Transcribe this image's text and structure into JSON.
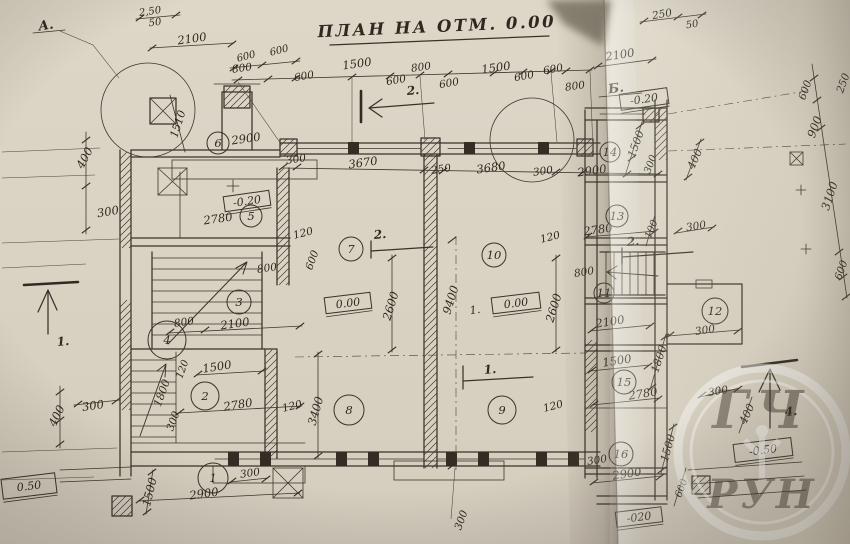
{
  "title": "ПЛАН НА ОТМ. 0.00",
  "watermark": {
    "top": "ГЧ",
    "bottom": "РУН"
  },
  "axis_labels": [
    {
      "t": "А.",
      "x": 46,
      "y": 26,
      "r": -8
    },
    {
      "t": "Б.",
      "x": 616,
      "y": 89,
      "r": -8
    }
  ],
  "section_labels": [
    {
      "t": "1.",
      "x": 63,
      "y": 342,
      "r": -5
    },
    {
      "t": "2.",
      "x": 413,
      "y": 91,
      "r": -5
    },
    {
      "t": "2.",
      "x": 380,
      "y": 235,
      "r": -5
    },
    {
      "t": "2.",
      "x": 633,
      "y": 242,
      "r": -5
    },
    {
      "t": "1.",
      "x": 490,
      "y": 370,
      "r": -5
    },
    {
      "t": "4.",
      "x": 791,
      "y": 412,
      "r": -5
    }
  ],
  "elevation_marks": [
    {
      "t": "-0.20",
      "x": 644,
      "y": 99,
      "r": -8,
      "w": 48,
      "h": 16
    },
    {
      "t": "-0.20",
      "x": 247,
      "y": 201,
      "r": -8,
      "w": 46,
      "h": 15
    },
    {
      "t": "0.00",
      "x": 348,
      "y": 303,
      "r": -7,
      "w": 46,
      "h": 16
    },
    {
      "t": "0.00",
      "x": 516,
      "y": 303,
      "r": -7,
      "w": 48,
      "h": 16
    },
    {
      "t": "-0.50",
      "x": 763,
      "y": 450,
      "r": -7,
      "w": 58,
      "h": 18
    },
    {
      "t": "0.50",
      "x": 29,
      "y": 486,
      "r": -7,
      "w": 54,
      "h": 20
    },
    {
      "t": "-020",
      "x": 639,
      "y": 517,
      "r": -7,
      "w": 46,
      "h": 15
    }
  ],
  "rooms": [
    {
      "n": "1",
      "x": 213,
      "y": 478,
      "cr": 15
    },
    {
      "n": "2",
      "x": 205,
      "y": 396,
      "cr": 14
    },
    {
      "n": "3",
      "x": 239,
      "y": 302,
      "cr": 12
    },
    {
      "n": "4",
      "x": 167,
      "y": 340,
      "cr": 19
    },
    {
      "n": "5",
      "x": 251,
      "y": 216,
      "cr": 11
    },
    {
      "n": "6",
      "x": 218,
      "y": 143,
      "cr": 11
    },
    {
      "n": "7",
      "x": 351,
      "y": 249,
      "cr": 12
    },
    {
      "n": "8",
      "x": 349,
      "y": 410,
      "cr": 15
    },
    {
      "n": "9",
      "x": 502,
      "y": 410,
      "cr": 14
    },
    {
      "n": "10",
      "x": 494,
      "y": 255,
      "cr": 12
    },
    {
      "n": "11",
      "x": 604,
      "y": 293,
      "cr": 10
    },
    {
      "n": "12",
      "x": 715,
      "y": 311,
      "cr": 13
    },
    {
      "n": "13",
      "x": 617,
      "y": 216,
      "cr": 11
    },
    {
      "n": "14",
      "x": 610,
      "y": 152,
      "cr": 10
    },
    {
      "n": "15",
      "x": 624,
      "y": 382,
      "cr": 12
    },
    {
      "n": "16",
      "x": 621,
      "y": 454,
      "cr": 12
    }
  ],
  "dim_labels": [
    {
      "t": "2,50",
      "x": 150,
      "y": 11,
      "r": -8,
      "fs": 10
    },
    {
      "t": "50",
      "x": 155,
      "y": 22,
      "r": -8,
      "fs": 10
    },
    {
      "t": "2100",
      "x": 192,
      "y": 39,
      "r": -8
    },
    {
      "t": "600",
      "x": 246,
      "y": 56,
      "r": -14,
      "fs": 10
    },
    {
      "t": "600",
      "x": 279,
      "y": 50,
      "r": -14,
      "fs": 10
    },
    {
      "t": "800",
      "x": 242,
      "y": 68,
      "r": -8,
      "fs": 10.5
    },
    {
      "t": "600",
      "x": 304,
      "y": 76,
      "r": -10,
      "fs": 10.5
    },
    {
      "t": "1500",
      "x": 357,
      "y": 64,
      "r": -8
    },
    {
      "t": "600",
      "x": 396,
      "y": 80,
      "r": -10,
      "fs": 10.5
    },
    {
      "t": "800",
      "x": 421,
      "y": 67,
      "r": -8,
      "fs": 10.5
    },
    {
      "t": "600",
      "x": 449,
      "y": 83,
      "r": -10,
      "fs": 10.5
    },
    {
      "t": "1500",
      "x": 496,
      "y": 68,
      "r": -8
    },
    {
      "t": "600",
      "x": 524,
      "y": 76,
      "r": -10,
      "fs": 10.5
    },
    {
      "t": "600",
      "x": 553,
      "y": 69,
      "r": -10,
      "fs": 10.5
    },
    {
      "t": "800",
      "x": 575,
      "y": 86,
      "r": -8,
      "fs": 10.5
    },
    {
      "t": "250",
      "x": 662,
      "y": 14,
      "r": -10,
      "fs": 10.5
    },
    {
      "t": "50",
      "x": 692,
      "y": 24,
      "r": -10,
      "fs": 10
    },
    {
      "t": "2100",
      "x": 620,
      "y": 55,
      "r": -9
    },
    {
      "t": "300",
      "x": 296,
      "y": 159,
      "r": -8,
      "fs": 10.5
    },
    {
      "t": "3670",
      "x": 363,
      "y": 163,
      "r": -8
    },
    {
      "t": "250",
      "x": 441,
      "y": 169,
      "r": -8,
      "fs": 10.5
    },
    {
      "t": "3680",
      "x": 491,
      "y": 168,
      "r": -8
    },
    {
      "t": "300",
      "x": 543,
      "y": 171,
      "r": -8,
      "fs": 10.5
    },
    {
      "t": "2900",
      "x": 592,
      "y": 171,
      "r": -8
    },
    {
      "t": "2900",
      "x": 246,
      "y": 139,
      "r": -8
    },
    {
      "t": "1510",
      "x": 178,
      "y": 124,
      "r": -72,
      "fs": 11
    },
    {
      "t": "400",
      "x": 85,
      "y": 158,
      "r": -62
    },
    {
      "t": "300",
      "x": 108,
      "y": 212,
      "r": -10
    },
    {
      "t": "400",
      "x": 57,
      "y": 416,
      "r": -64
    },
    {
      "t": "300",
      "x": 93,
      "y": 406,
      "r": -8
    },
    {
      "t": "1500",
      "x": 150,
      "y": 492,
      "r": -76
    },
    {
      "t": "2780",
      "x": 218,
      "y": 219,
      "r": -8
    },
    {
      "t": "120",
      "x": 303,
      "y": 233,
      "r": -14,
      "fs": 10.5
    },
    {
      "t": "800",
      "x": 267,
      "y": 268,
      "r": -8,
      "fs": 10.5
    },
    {
      "t": "600",
      "x": 312,
      "y": 260,
      "r": -70,
      "fs": 10.5
    },
    {
      "t": "800",
      "x": 184,
      "y": 322,
      "r": -8,
      "fs": 10.5
    },
    {
      "t": "2100",
      "x": 235,
      "y": 324,
      "r": -8
    },
    {
      "t": "1500",
      "x": 217,
      "y": 367,
      "r": -9
    },
    {
      "t": "2780",
      "x": 238,
      "y": 405,
      "r": -9
    },
    {
      "t": "120",
      "x": 292,
      "y": 406,
      "r": -14,
      "fs": 10.5
    },
    {
      "t": "1800",
      "x": 162,
      "y": 393,
      "r": -70,
      "fs": 11
    },
    {
      "t": "120",
      "x": 182,
      "y": 369,
      "r": -70,
      "fs": 10
    },
    {
      "t": "300",
      "x": 173,
      "y": 421,
      "r": -70,
      "fs": 10.5
    },
    {
      "t": "3400",
      "x": 316,
      "y": 411,
      "r": -74,
      "fs": 11.5
    },
    {
      "t": "300",
      "x": 250,
      "y": 473,
      "r": -8,
      "fs": 10.5
    },
    {
      "t": "2900",
      "x": 204,
      "y": 494,
      "r": -8
    },
    {
      "t": "2600",
      "x": 391,
      "y": 306,
      "r": -73,
      "fs": 11.5
    },
    {
      "t": "9400",
      "x": 451,
      "y": 300,
      "r": -73,
      "fs": 11.5
    },
    {
      "t": "2600",
      "x": 554,
      "y": 308,
      "r": -73,
      "fs": 11.5
    },
    {
      "t": "1.",
      "x": 475,
      "y": 310,
      "r": -8,
      "fs": 11
    },
    {
      "t": "120",
      "x": 550,
      "y": 237,
      "r": -14,
      "fs": 10.5
    },
    {
      "t": "120",
      "x": 553,
      "y": 406,
      "r": -14,
      "fs": 10.5
    },
    {
      "t": "300",
      "x": 461,
      "y": 520,
      "r": -70,
      "fs": 10.5
    },
    {
      "t": "2780",
      "x": 598,
      "y": 230,
      "r": -8,
      "fs": 11.5
    },
    {
      "t": "800",
      "x": 584,
      "y": 272,
      "r": -9,
      "fs": 10.5
    },
    {
      "t": "2100",
      "x": 610,
      "y": 322,
      "r": -9,
      "fs": 11.5
    },
    {
      "t": "300",
      "x": 705,
      "y": 330,
      "r": -9,
      "fs": 10.5
    },
    {
      "t": "1500",
      "x": 617,
      "y": 361,
      "r": -9,
      "fs": 11.5
    },
    {
      "t": "2780",
      "x": 643,
      "y": 394,
      "r": -9,
      "fs": 11.5
    },
    {
      "t": "300",
      "x": 597,
      "y": 460,
      "r": -9,
      "fs": 10.5
    },
    {
      "t": "2900",
      "x": 627,
      "y": 474,
      "r": -9,
      "fs": 11.5
    },
    {
      "t": "1500",
      "x": 636,
      "y": 144,
      "r": -70,
      "fs": 11
    },
    {
      "t": "300",
      "x": 650,
      "y": 164,
      "r": -70,
      "fs": 10
    },
    {
      "t": "100",
      "x": 651,
      "y": 229,
      "r": -68,
      "fs": 10
    },
    {
      "t": "1800",
      "x": 659,
      "y": 359,
      "r": -72,
      "fs": 11
    },
    {
      "t": "1500",
      "x": 668,
      "y": 448,
      "r": -74,
      "fs": 11
    },
    {
      "t": "400",
      "x": 695,
      "y": 159,
      "r": -65,
      "fs": 11
    },
    {
      "t": "300",
      "x": 696,
      "y": 226,
      "r": -9,
      "fs": 10.5
    },
    {
      "t": "300",
      "x": 718,
      "y": 391,
      "r": -9,
      "fs": 10.5
    },
    {
      "t": "400",
      "x": 747,
      "y": 414,
      "r": -65,
      "fs": 11
    },
    {
      "t": "600",
      "x": 681,
      "y": 488,
      "r": -70,
      "fs": 10
    },
    {
      "t": "250",
      "x": 843,
      "y": 83,
      "r": -70,
      "fs": 10.5
    },
    {
      "t": "600",
      "x": 805,
      "y": 90,
      "r": -70,
      "fs": 10.5
    },
    {
      "t": "900",
      "x": 815,
      "y": 127,
      "r": -70,
      "fs": 11.5
    },
    {
      "t": "3100",
      "x": 830,
      "y": 196,
      "r": -72,
      "fs": 11.5
    },
    {
      "t": "600",
      "x": 841,
      "y": 270,
      "r": -70,
      "fs": 10.5
    }
  ]
}
